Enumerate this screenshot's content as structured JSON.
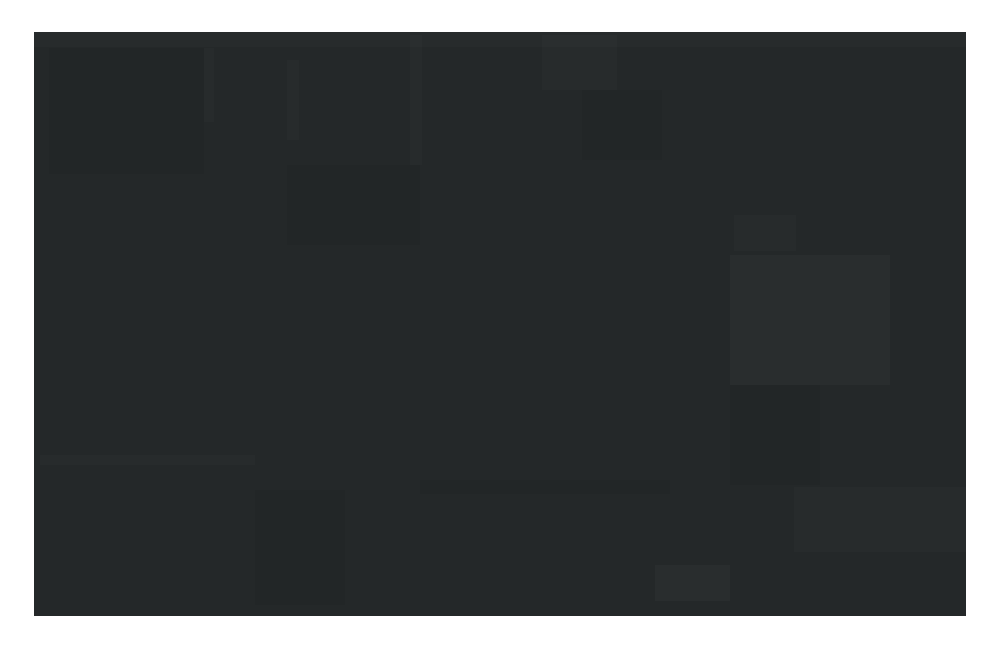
{
  "screen": {
    "content": ""
  },
  "colors": {
    "page_background": "#ffffff",
    "screen_background": "#242829",
    "artifact_light": "#262b2c",
    "artifact_dark": "#222627"
  }
}
